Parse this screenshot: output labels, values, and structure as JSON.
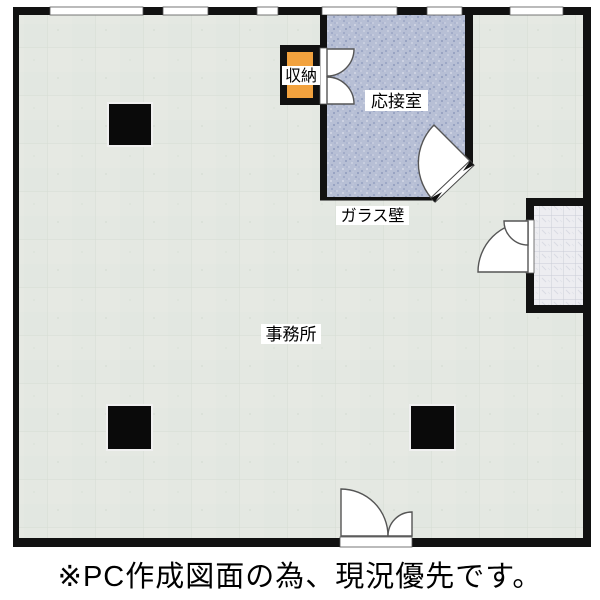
{
  "caption": "※PC作成図面の為、現況優先です。",
  "rooms": {
    "office": {
      "label": "事務所"
    },
    "reception": {
      "label": "応接室"
    },
    "storage": {
      "label": "収納"
    }
  },
  "annotations": {
    "glass_wall": "ガラス壁"
  },
  "features": {
    "pillars": 3,
    "top_wall_windows": 6,
    "doors": [
      "reception-corner-door",
      "storage-double-door",
      "tiled-room-door",
      "main-entrance-double-door"
    ]
  },
  "colors": {
    "wall": "#111111",
    "office-floor": "#e4e8e2",
    "reception-floor": "#b7bfd5",
    "storage-fill": "#f2a23e",
    "tile-floor": "#ededf1",
    "door-fill": "#ffffff",
    "door-outline": "#555555",
    "text": "#000000",
    "background": "#ffffff"
  }
}
